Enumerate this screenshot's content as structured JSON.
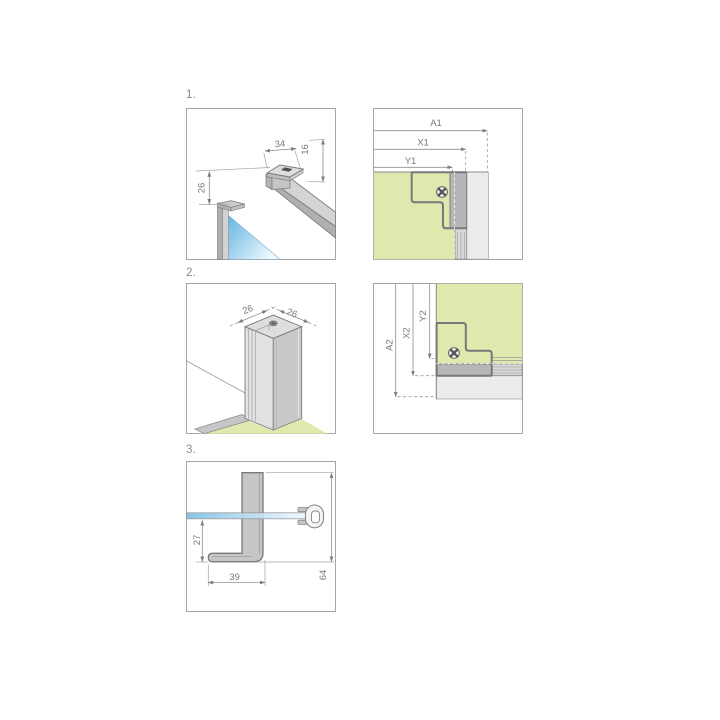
{
  "steps": [
    {
      "label": "1."
    },
    {
      "label": "2."
    },
    {
      "label": "3."
    }
  ],
  "panels": {
    "p1": {
      "dim_width": "34",
      "dim_height": "16",
      "dim_offset": "26"
    },
    "p2": {
      "dim_a": "A1",
      "dim_x": "X1",
      "dim_y": "Y1"
    },
    "p3": {
      "dim_left": "26",
      "dim_right": "26"
    },
    "p4": {
      "dim_a": "A2",
      "dim_x": "X2",
      "dim_y": "Y2"
    },
    "p5": {
      "dim_drop": "27",
      "dim_foot": "39",
      "dim_total": "64"
    }
  },
  "icons": {
    "screw": "phillips-screw"
  },
  "colors": {
    "wall_green": "#dde9ad",
    "glass_blue": "#5ab1e1",
    "profile_gray": "#c6c6c6",
    "dim_line_gray": "#8f8f8f",
    "dim_text_gray": "#7a7a7a",
    "panel_border_gray": "#a5a5a5"
  }
}
